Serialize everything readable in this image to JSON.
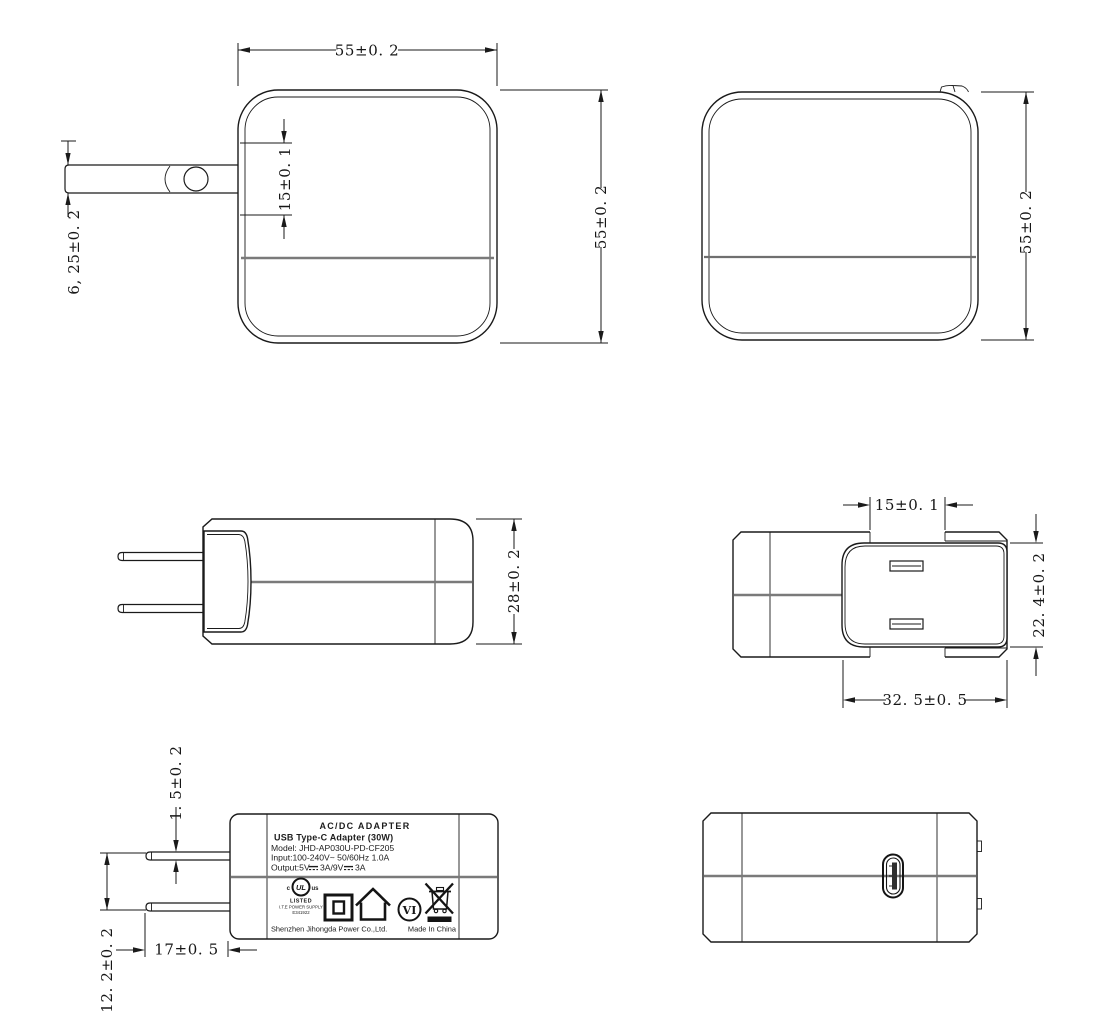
{
  "dims": {
    "front_width": "55±0. 2",
    "front_height": "55±0. 2",
    "front_slot": "15±0. 1",
    "front_blade": "6, 25±0. 2",
    "rear_height": "55±0. 2",
    "side_depth": "28±0. 2",
    "top_pin_span": "15±0. 1",
    "top_face_depth": "22. 4±0. 2",
    "top_face_width": "32. 5±0. 5",
    "label_pin_thickness": "1. 5±0. 2",
    "label_pin_spacing": "12. 2±0. 2",
    "label_pin_length": "17±0. 5"
  },
  "label": {
    "line1": "AC/DC  ADAPTER",
    "line2": "USB Type-C Adapter   (30W)",
    "line3": "Model: JHD-AP030U-PD-CF205",
    "line4": "Input:100-240V~  50/60Hz  1.0A",
    "output_prefix": "Output:5V",
    "output_mid": "3A/9V",
    "output_suffix": "3A",
    "ul": {
      "c": "c",
      "mark": "UL",
      "us": "us",
      "listed": "LISTED",
      "supply": "I.T.E POWER SUPPLY",
      "file": "E341922"
    },
    "efficiency": "VI",
    "manufacturer": "Shenzhen Jihongda Power Co.,Ltd.",
    "origin": "Made In China"
  },
  "colors": {
    "line": "#1a1a1a",
    "parting_line": "#7a7a7a"
  }
}
